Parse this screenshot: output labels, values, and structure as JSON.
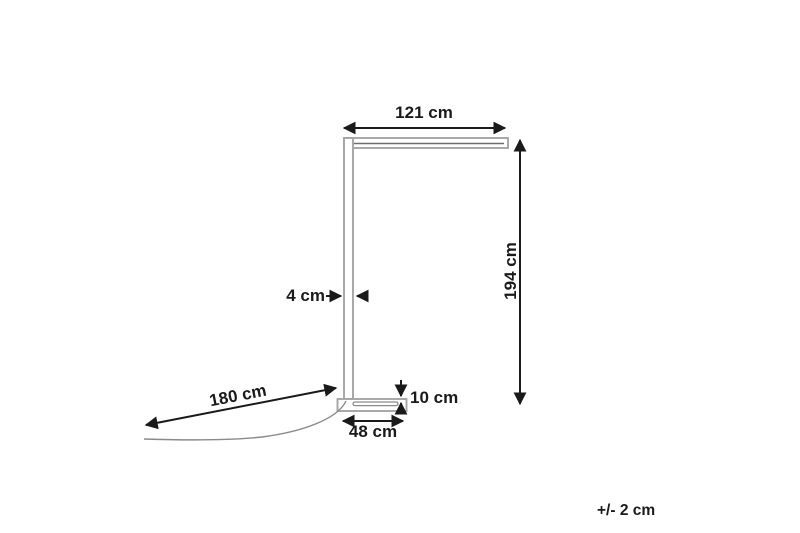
{
  "diagram": {
    "type": "product-dimension-drawing",
    "subject": "floor-lamp",
    "labels": {
      "arm_width": "121 cm",
      "total_height": "194 cm",
      "pole_depth": "4 cm",
      "cable_length": "180 cm",
      "base_height": "10 cm",
      "base_width": "48 cm",
      "tolerance": "+/- 2 cm"
    },
    "colors": {
      "annotation": "#1a1a1a",
      "lamp_outline": "#a5a5a5",
      "lamp_inner_line": "#6e6e6e",
      "cable": "#8a8a8a",
      "background": "#ffffff"
    }
  }
}
